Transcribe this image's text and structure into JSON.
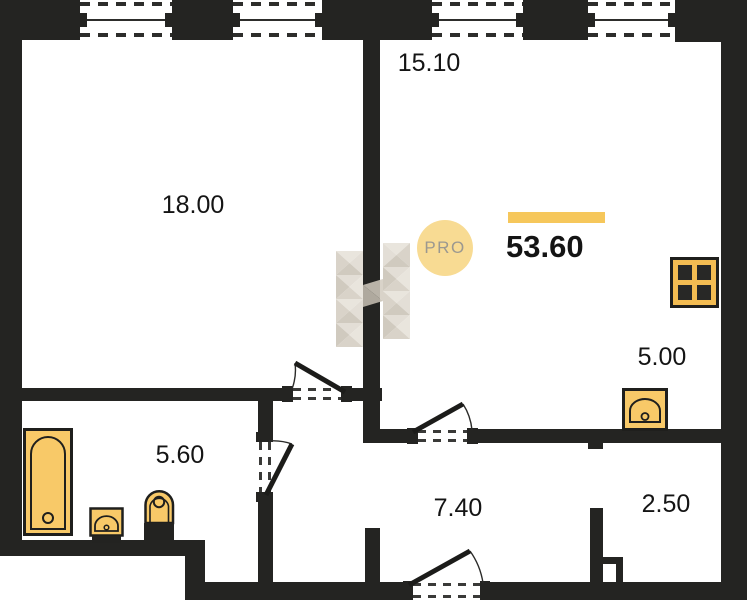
{
  "plan": {
    "badge_label": "PRO",
    "total_area": "53.60",
    "rooms": {
      "living": "18.00",
      "main": "15.10",
      "kitchen": "5.00",
      "bathroom": "5.60",
      "hallway": "7.40",
      "storage": "2.50"
    },
    "icons": [
      "bathtub-icon",
      "washbasin-icon",
      "toilet-icon",
      "kitchen-sink-icon",
      "stove-icon",
      "window-icon",
      "door-swing-icon",
      "vent-shaft-icon",
      "watermark-logo",
      "pro-badge"
    ],
    "colors": {
      "wall": "#242422",
      "fixture_fill": "#F8C968",
      "stove_fill": "#F3BC52",
      "accent_bar": "#F6C75B",
      "badge_fill": "#F8DB93",
      "badge_text": "#9B9890",
      "watermark_light": "#E6E1D8",
      "watermark_dark": "#C8C1B4"
    }
  }
}
